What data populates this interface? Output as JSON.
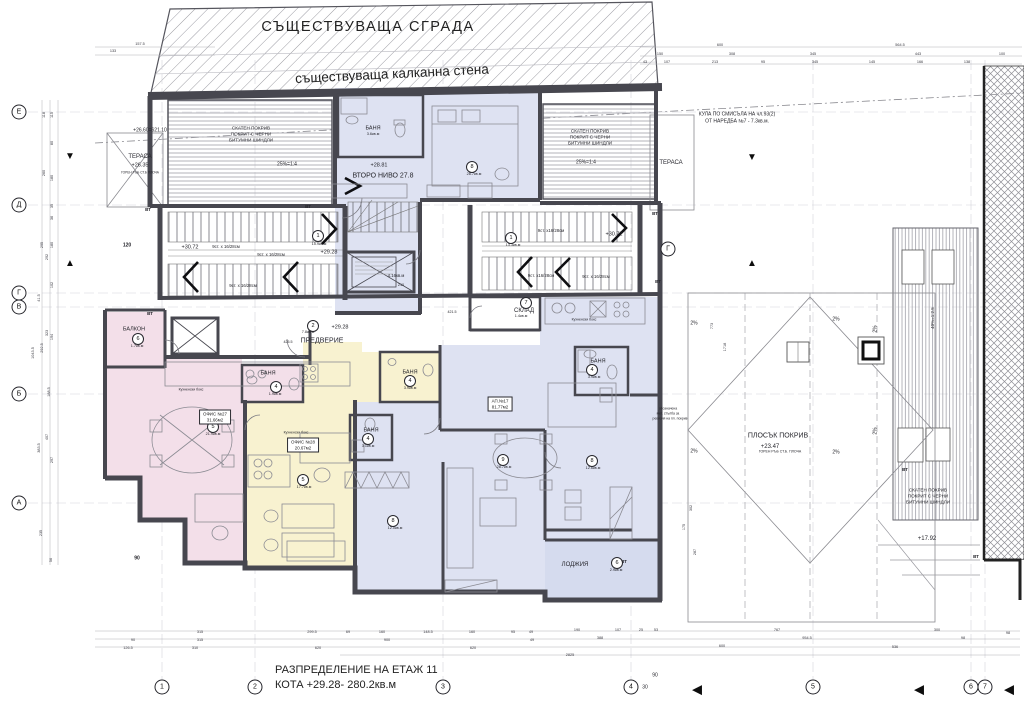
{
  "title_block": {
    "line1": "РАЗПРЕДЕЛЕНИЕ НА ЕТАЖ 11",
    "line2": "КОТА +29.28- 280.2кв.м"
  },
  "site": {
    "existing_building": "СЪЩЕСТВУВАЩА СГРАДА",
    "party_wall": "съществуваща калканна стена"
  },
  "colors": {
    "pink": "#f3dfe9",
    "yellow": "#f8f2d0",
    "blue": "#dee2f2",
    "lodge": "#d5dbee",
    "wall": "#47474f"
  },
  "annotations": [
    {
      "t": "КУЛА ПО СМИСЪЛА НА чл.93(2)",
      "x": 737,
      "y": 115,
      "fs": 5
    },
    {
      "t": "ОТ НАРЕДБА №7 - 7.3кв.м.",
      "x": 737,
      "y": 122,
      "fs": 5
    },
    {
      "t": "+26.60=621.10",
      "x": 150,
      "y": 131,
      "fs": 5
    },
    {
      "t": "ТЕРАСА",
      "x": 140,
      "y": 157,
      "fs": 6
    },
    {
      "t": "+26.35",
      "x": 140,
      "y": 166,
      "fs": 5.5
    },
    {
      "t": "ГОРЕН РЪБ СТ.Б ПЛОЧА",
      "x": 140,
      "y": 173,
      "fs": 3.2
    },
    {
      "t": "СКАТЕН ПОКРИВ",
      "x": 251,
      "y": 129,
      "fs": 4.6
    },
    {
      "t": "ПОКРИТ С ЧЕРНИ",
      "x": 251,
      "y": 135,
      "fs": 4.6
    },
    {
      "t": "БИТУМНИ ШИНДЛИ",
      "x": 251,
      "y": 141,
      "fs": 4.6
    },
    {
      "t": "25%=1:4",
      "x": 287,
      "y": 165,
      "fs": 5
    },
    {
      "t": "СКАТЕН ПОКРИВ",
      "x": 590,
      "y": 132,
      "fs": 4.6
    },
    {
      "t": "ПОКРИТ С ЧЕРНИ",
      "x": 590,
      "y": 138,
      "fs": 4.6
    },
    {
      "t": "БИТУМНИ ШИНДЛИ",
      "x": 590,
      "y": 144,
      "fs": 4.6
    },
    {
      "t": "25%=1:4",
      "x": 586,
      "y": 163,
      "fs": 5
    },
    {
      "t": "ТЕРАСА",
      "x": 671,
      "y": 163,
      "fs": 6
    },
    {
      "t": "СКАТЕН ПОКРИВ",
      "x": 928,
      "y": 491,
      "fs": 4.6
    },
    {
      "t": "ПОКРИТ С ЧЕРНИ",
      "x": 928,
      "y": 497,
      "fs": 4.6
    },
    {
      "t": "БИТУМНИ ШИНДЛИ",
      "x": 928,
      "y": 503,
      "fs": 4.6
    },
    {
      "t": "40%=1:2.5",
      "x": 933,
      "y": 318,
      "fs": 4.5,
      "rot": -90
    },
    {
      "t": "ПЛОСЪК ПОКРИВ",
      "x": 778,
      "y": 436,
      "fs": 7
    },
    {
      "t": "+23.47",
      "x": 770,
      "y": 447,
      "fs": 6
    },
    {
      "t": "ГОРЕН РЪБ СТ.Б. ПЛОЧА",
      "x": 780,
      "y": 452,
      "fs": 3.5
    },
    {
      "t": "+17.92",
      "x": 927,
      "y": 539,
      "fs": 6
    },
    {
      "t": "2%",
      "x": 694,
      "y": 324,
      "fs": 5
    },
    {
      "t": "2%",
      "x": 836,
      "y": 320,
      "fs": 5
    },
    {
      "t": "2%",
      "x": 694,
      "y": 452,
      "fs": 5
    },
    {
      "t": "2%",
      "x": 836,
      "y": 453,
      "fs": 5
    },
    {
      "t": "2%",
      "x": 876,
      "y": 329,
      "fs": 5,
      "rot": -90
    },
    {
      "t": "2%",
      "x": 876,
      "y": 431,
      "fs": 5,
      "rot": -90
    },
    {
      "t": "+28.81",
      "x": 379,
      "y": 166,
      "fs": 5.5
    },
    {
      "t": "ВТОРО НИВО 27.8",
      "x": 383,
      "y": 176,
      "fs": 7
    },
    {
      "t": "БАНЯ",
      "x": 373,
      "y": 129,
      "fs": 5.5
    },
    {
      "t": "3.6кв.м",
      "x": 373,
      "y": 135,
      "fs": 3.8
    },
    {
      "t": "БАНЯ",
      "x": 268,
      "y": 374,
      "fs": 5.5
    },
    {
      "t": "БАНЯ",
      "x": 410,
      "y": 373,
      "fs": 5.5
    },
    {
      "t": "БАНЯ",
      "x": 371,
      "y": 431,
      "fs": 5.5
    },
    {
      "t": "БАНЯ",
      "x": 598,
      "y": 362,
      "fs": 5.5
    },
    {
      "t": "СКЛАД",
      "x": 524,
      "y": 311,
      "fs": 6
    },
    {
      "t": "1.4кв.м",
      "x": 521,
      "y": 317,
      "fs": 3.8
    },
    {
      "t": "БАЛКОН",
      "x": 134,
      "y": 330,
      "fs": 5.5
    },
    {
      "t": "ПРЕДВЕРИЕ",
      "x": 322,
      "y": 341,
      "fs": 7
    },
    {
      "t": "ЛОДЖИЯ",
      "x": 575,
      "y": 565,
      "fs": 6
    },
    {
      "t": "9ст. х 16/28см",
      "x": 226,
      "y": 247,
      "fs": 4.3
    },
    {
      "t": "9ст. х 16/28см",
      "x": 271,
      "y": 255,
      "fs": 4.3
    },
    {
      "t": "9ст. х 16/28см",
      "x": 243,
      "y": 286,
      "fs": 4.3
    },
    {
      "t": "9ст. х16/28см",
      "x": 551,
      "y": 231,
      "fs": 4.3
    },
    {
      "t": "9ст. х16/28см",
      "x": 541,
      "y": 276,
      "fs": 4.3
    },
    {
      "t": "9ст. х 16/28см",
      "x": 596,
      "y": 277,
      "fs": 4.3
    },
    {
      "t": "+30.72",
      "x": 190,
      "y": 248,
      "fs": 5.5
    },
    {
      "t": "+29.28",
      "x": 329,
      "y": 253,
      "fs": 5.5
    },
    {
      "t": "+30.72",
      "x": 614,
      "y": 235,
      "fs": 5.5
    },
    {
      "t": "+29.28",
      "x": 340,
      "y": 328,
      "fs": 5.5
    },
    {
      "t": "Кухненски бокс",
      "x": 191,
      "y": 390,
      "fs": 3.5
    },
    {
      "t": "Кухненски бокс",
      "x": 296,
      "y": 433,
      "fs": 3.5
    },
    {
      "t": "Кухненски бокс",
      "x": 584,
      "y": 320,
      "fs": 3.5
    },
    {
      "t": "4.16кв.м",
      "x": 396,
      "y": 276,
      "fs": 4.3
    },
    {
      "t": "210",
      "x": 401,
      "y": 286,
      "fs": 3.8
    },
    {
      "t": "обозначена",
      "x": 668,
      "y": 409,
      "fs": 3.4
    },
    {
      "t": "мет. стълба за",
      "x": 668,
      "y": 414,
      "fs": 3.4
    },
    {
      "t": "ревизия на пл. покрив",
      "x": 670,
      "y": 419,
      "fs": 3.4
    },
    {
      "t": "ВТ",
      "x": 148,
      "y": 210,
      "fs": 4.5,
      "b": 1
    },
    {
      "t": "ВТ",
      "x": 308,
      "y": 207,
      "fs": 4.5,
      "b": 1
    },
    {
      "t": "ВТ",
      "x": 655,
      "y": 214,
      "fs": 4.5,
      "b": 1
    },
    {
      "t": "ВТ",
      "x": 658,
      "y": 282,
      "fs": 4.5,
      "b": 1
    },
    {
      "t": "ВТ",
      "x": 150,
      "y": 314,
      "fs": 4.5,
      "b": 1
    },
    {
      "t": "ВТ",
      "x": 624,
      "y": 562,
      "fs": 4.5,
      "b": 1
    },
    {
      "t": "ВТ",
      "x": 905,
      "y": 470,
      "fs": 4.5,
      "b": 1
    },
    {
      "t": "ВТ",
      "x": 976,
      "y": 557,
      "fs": 4.5,
      "b": 1
    },
    {
      "t": "120",
      "x": 127,
      "y": 246,
      "fs": 5,
      "b": 1
    },
    {
      "t": "90",
      "x": 137,
      "y": 559,
      "fs": 5,
      "b": 1
    },
    {
      "t": "90",
      "x": 655,
      "y": 676,
      "fs": 5
    },
    {
      "t": "30",
      "x": 645,
      "y": 688,
      "fs": 5
    },
    {
      "t": "425.5",
      "x": 288,
      "y": 343,
      "fs": 3.6
    },
    {
      "t": "421.5",
      "x": 452,
      "y": 313,
      "fs": 3.6
    }
  ],
  "dims": [
    {
      "t": "315",
      "x": 200,
      "y": 633
    },
    {
      "t": "299.5",
      "x": 312,
      "y": 633
    },
    {
      "t": "69",
      "x": 348,
      "y": 633
    },
    {
      "t": "160",
      "x": 382,
      "y": 633
    },
    {
      "t": "148.5",
      "x": 428,
      "y": 633
    },
    {
      "t": "160",
      "x": 472,
      "y": 633
    },
    {
      "t": "95",
      "x": 513,
      "y": 633
    },
    {
      "t": "49",
      "x": 531,
      "y": 633
    },
    {
      "t": "190",
      "x": 577,
      "y": 631
    },
    {
      "t": "107",
      "x": 618,
      "y": 631
    },
    {
      "t": "25",
      "x": 641,
      "y": 631
    },
    {
      "t": "53",
      "x": 656,
      "y": 631
    },
    {
      "t": "767",
      "x": 777,
      "y": 631
    },
    {
      "t": "300",
      "x": 937,
      "y": 631
    },
    {
      "t": "98",
      "x": 1008,
      "y": 634
    },
    {
      "t": "90",
      "x": 133,
      "y": 641
    },
    {
      "t": "315",
      "x": 200,
      "y": 641
    },
    {
      "t": "900",
      "x": 387,
      "y": 641
    },
    {
      "t": "49",
      "x": 532,
      "y": 641
    },
    {
      "t": "388",
      "x": 600,
      "y": 639
    },
    {
      "t": "954.5",
      "x": 807,
      "y": 639
    },
    {
      "t": "98",
      "x": 963,
      "y": 639
    },
    {
      "t": "126.5",
      "x": 128,
      "y": 649
    },
    {
      "t": "310",
      "x": 195,
      "y": 649
    },
    {
      "t": "620",
      "x": 318,
      "y": 649
    },
    {
      "t": "620",
      "x": 473,
      "y": 649
    },
    {
      "t": "600",
      "x": 722,
      "y": 647
    },
    {
      "t": "536",
      "x": 895,
      "y": 648
    },
    {
      "t": "2825",
      "x": 570,
      "y": 656
    },
    {
      "t": "115",
      "x": 53,
      "y": 115,
      "rot": -90
    },
    {
      "t": "118",
      "x": 45,
      "y": 115,
      "rot": -90
    },
    {
      "t": "80",
      "x": 53,
      "y": 143,
      "rot": -90
    },
    {
      "t": "260",
      "x": 45,
      "y": 173,
      "rot": -90
    },
    {
      "t": "180",
      "x": 53,
      "y": 178,
      "rot": -90
    },
    {
      "t": "35",
      "x": 53,
      "y": 206,
      "rot": -90
    },
    {
      "t": "36",
      "x": 53,
      "y": 218,
      "rot": -90
    },
    {
      "t": "295",
      "x": 43,
      "y": 245,
      "rot": -90
    },
    {
      "t": "180",
      "x": 53,
      "y": 245,
      "rot": -90
    },
    {
      "t": "292",
      "x": 48,
      "y": 257,
      "rot": -90
    },
    {
      "t": "102",
      "x": 53,
      "y": 285,
      "rot": -90
    },
    {
      "t": "41.5",
      "x": 40,
      "y": 298,
      "rot": -90
    },
    {
      "t": "323",
      "x": 48,
      "y": 333,
      "rot": -90
    },
    {
      "t": "194",
      "x": 53,
      "y": 337,
      "rot": -90
    },
    {
      "t": "1043.5",
      "x": 34,
      "y": 353,
      "rot": -90
    },
    {
      "t": "292.5",
      "x": 43,
      "y": 348,
      "rot": -90
    },
    {
      "t": "188.5",
      "x": 50,
      "y": 392,
      "rot": -90
    },
    {
      "t": "407",
      "x": 48,
      "y": 437,
      "rot": -90
    },
    {
      "t": "383.5",
      "x": 40,
      "y": 448,
      "rot": -90
    },
    {
      "t": "297",
      "x": 53,
      "y": 460,
      "rot": -90
    },
    {
      "t": "235",
      "x": 42,
      "y": 533,
      "rot": -90
    },
    {
      "t": "56",
      "x": 52,
      "y": 560,
      "rot": -90
    },
    {
      "t": "157.5",
      "x": 140,
      "y": 45
    },
    {
      "t": "133",
      "x": 113,
      "y": 52
    },
    {
      "t": "600",
      "x": 720,
      "y": 46
    },
    {
      "t": "564.5",
      "x": 900,
      "y": 46
    },
    {
      "t": "150",
      "x": 660,
      "y": 55
    },
    {
      "t": "308",
      "x": 732,
      "y": 55
    },
    {
      "t": "345",
      "x": 813,
      "y": 55
    },
    {
      "t": "443",
      "x": 918,
      "y": 55
    },
    {
      "t": "100",
      "x": 1002,
      "y": 55
    },
    {
      "t": "43",
      "x": 645,
      "y": 63
    },
    {
      "t": "107",
      "x": 667,
      "y": 63
    },
    {
      "t": "213",
      "x": 715,
      "y": 63
    },
    {
      "t": "95",
      "x": 763,
      "y": 63
    },
    {
      "t": "345",
      "x": 815,
      "y": 63
    },
    {
      "t": "145",
      "x": 872,
      "y": 63
    },
    {
      "t": "166",
      "x": 920,
      "y": 63
    },
    {
      "t": "138",
      "x": 967,
      "y": 63
    },
    {
      "t": "773",
      "x": 713,
      "y": 326,
      "rot": -90
    },
    {
      "t": "1718",
      "x": 726,
      "y": 347,
      "rot": -90
    },
    {
      "t": "302",
      "x": 692,
      "y": 508,
      "rot": -90
    },
    {
      "t": "175",
      "x": 685,
      "y": 527,
      "rot": -90
    },
    {
      "t": "287",
      "x": 696,
      "y": 552,
      "rot": -90
    }
  ],
  "room_badges": [
    {
      "num": "1",
      "x": 318,
      "y": 236,
      "area": "15.9кв.м",
      "ax": 319,
      "ay": 245
    },
    {
      "num": "1",
      "x": 511,
      "y": 238,
      "area": "13.3кв.м",
      "ax": 513,
      "ay": 246
    },
    {
      "num": "2",
      "x": 313,
      "y": 326,
      "area": "7.8кв.м",
      "ax": 308,
      "ay": 333
    },
    {
      "num": "7",
      "x": 526,
      "y": 303,
      "area": "",
      "ax": 0,
      "ay": 0
    },
    {
      "num": "6",
      "x": 138,
      "y": 339,
      "area": "1.7кв.м",
      "ax": 137,
      "ay": 347
    },
    {
      "num": "4",
      "x": 276,
      "y": 387,
      "area": "1.9кв.м",
      "ax": 275,
      "ay": 395
    },
    {
      "num": "4",
      "x": 410,
      "y": 381,
      "area": "3.9кв.м",
      "ax": 410,
      "ay": 389
    },
    {
      "num": "4",
      "x": 368,
      "y": 439,
      "area": "3.1кв.м",
      "ax": 368,
      "ay": 447
    },
    {
      "num": "4",
      "x": 592,
      "y": 370,
      "area": "3.9кв.м",
      "ax": 594,
      "ay": 378
    },
    {
      "num": "5",
      "x": 213,
      "y": 427,
      "area": "21.9кв.м",
      "ax": 213,
      "ay": 435
    },
    {
      "num": "5",
      "x": 303,
      "y": 480,
      "area": "17.7кв.м",
      "ax": 304,
      "ay": 488
    },
    {
      "num": "8",
      "x": 472,
      "y": 167,
      "area": "28.7кв.м",
      "ax": 474,
      "ay": 175
    },
    {
      "num": "8",
      "x": 393,
      "y": 521,
      "area": "12.0кв.м",
      "ax": 395,
      "ay": 529
    },
    {
      "num": "9",
      "x": 503,
      "y": 460,
      "area": "28.7кв.м",
      "ax": 504,
      "ay": 468
    },
    {
      "num": "8",
      "x": 592,
      "y": 461,
      "area": "12.6кв.м",
      "ax": 593,
      "ay": 469
    },
    {
      "num": "6",
      "x": 617,
      "y": 563,
      "area": "2.9кв.м",
      "ax": 616,
      "ay": 571
    }
  ],
  "unit_boxes": [
    {
      "l1": "ОФИС №27",
      "l2": "31.66м2",
      "x": 215,
      "y": 417
    },
    {
      "l1": "ОФИС №28",
      "l2": "20.67м2",
      "x": 303,
      "y": 445
    },
    {
      "l1": "АП.№17",
      "l2": "81.77м2",
      "x": 500,
      "y": 404
    }
  ],
  "axes": {
    "left": [
      {
        "id": "Е",
        "x": 19,
        "y": 112
      },
      {
        "id": "Д",
        "x": 19,
        "y": 205
      },
      {
        "id": "Г",
        "x": 19,
        "y": 293
      },
      {
        "id": "В",
        "x": 19,
        "y": 307
      },
      {
        "id": "Б",
        "x": 19,
        "y": 394
      },
      {
        "id": "А",
        "x": 19,
        "y": 503
      }
    ],
    "bottom": [
      {
        "id": "1",
        "x": 162,
        "y": 687
      },
      {
        "id": "2",
        "x": 255,
        "y": 687
      },
      {
        "id": "3",
        "x": 443,
        "y": 687
      },
      {
        "id": "4",
        "x": 631,
        "y": 687
      },
      {
        "id": "5",
        "x": 813,
        "y": 687
      },
      {
        "id": "6",
        "x": 971,
        "y": 687
      },
      {
        "id": "7",
        "x": 985,
        "y": 687
      }
    ],
    "extra": [
      {
        "id": "Г",
        "x": 668,
        "y": 249
      }
    ]
  },
  "triangles": [
    {
      "d": "down",
      "x": 70,
      "y": 157,
      "s": 10
    },
    {
      "d": "up",
      "x": 70,
      "y": 264,
      "s": 10
    },
    {
      "d": "down",
      "x": 752,
      "y": 158,
      "s": 10
    },
    {
      "d": "up",
      "x": 752,
      "y": 264,
      "s": 10
    },
    {
      "d": "left",
      "x": 697,
      "y": 689,
      "s": 13
    },
    {
      "d": "left",
      "x": 919,
      "y": 689,
      "s": 13
    },
    {
      "d": "left",
      "x": 1009,
      "y": 689,
      "s": 13
    }
  ]
}
